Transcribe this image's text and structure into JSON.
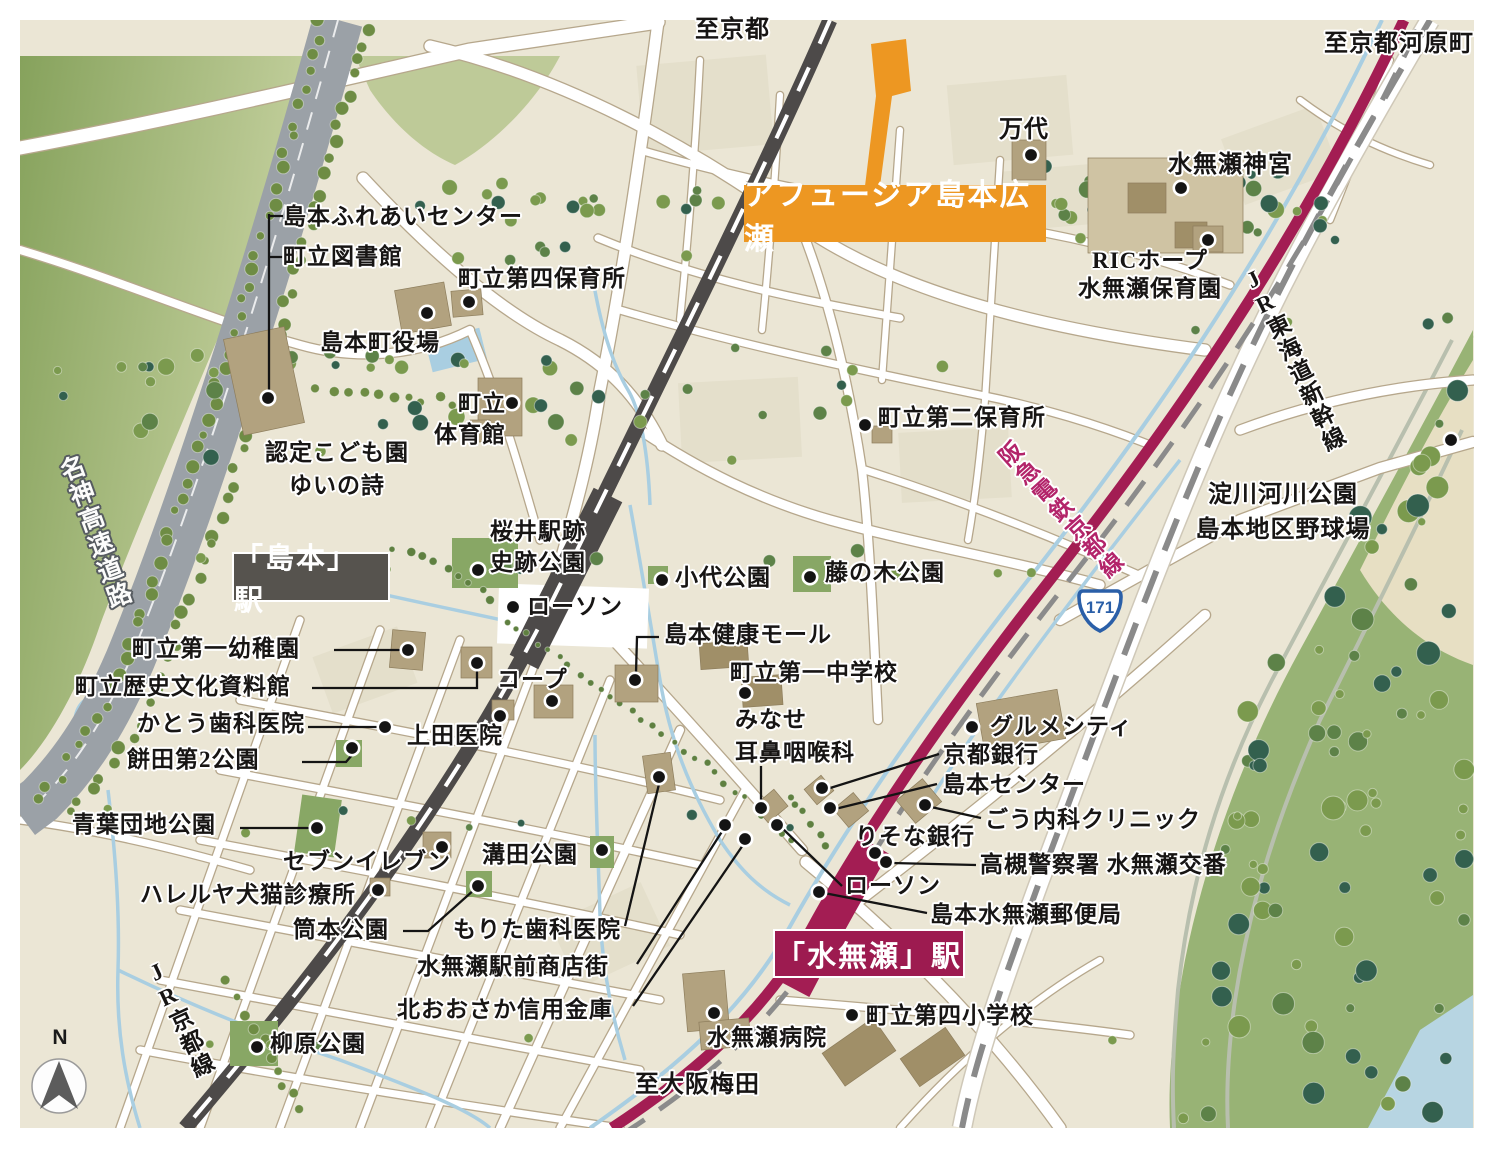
{
  "directions": {
    "to_kyoto": "至京都",
    "to_kyoto_kawaramachi": "至京都河原町",
    "to_osaka_umeda": "至大阪梅田"
  },
  "project": {
    "name": "アフュージア島本広瀬"
  },
  "stations": {
    "shimamoto": "「島本」駅",
    "minase": "「水無瀬」駅"
  },
  "railways": {
    "jr_kyoto_line": "JR京都線",
    "jr_tokaido_shinkansen": "JR東海道新幹線",
    "hankyu_kyoto_line": "阪急電鉄京都線",
    "meishin_expressway": "名神高速道路",
    "route_171": "171"
  },
  "compass": {
    "north": "N"
  },
  "pois": {
    "mandai": "万代",
    "minase_jingu": "水無瀬神宮",
    "ric_hope_line1": "RICホープ",
    "ric_hope_line2": "水無瀬保育園",
    "shimamoto_fureai_center": "島本ふれあいセンター",
    "town_library": "町立図書館",
    "dai4_hoikusho": "町立第四保育所",
    "shimamoto_yakuba": "島本町役場",
    "taiikukan_line1": "町立",
    "taiikukan_line2": "体育館",
    "kodomoen_line1": "認定こども園",
    "kodomoen_line2": "ゆいの詩",
    "dai2_hoikusho": "町立第二保育所",
    "yodogawa_line1": "淀川河川公園",
    "yodogawa_line2": "島本地区野球場",
    "sakurai_line1": "桜井駅跡",
    "sakurai_line2": "史跡公園",
    "lawson_north": "ローソン",
    "koshiro_koen": "小代公園",
    "fujinoki_koen": "藤の木公園",
    "kenko_mall": "島本健康モール",
    "dai1_chugakko": "町立第一中学校",
    "jibika_line1": "みなせ",
    "jibika_line2": "耳鼻咽喉科",
    "dai1_yochien": "町立第一幼稚園",
    "rekishi_shiryokan": "町立歴史文化資料館",
    "kato_shika": "かとう歯科医院",
    "mochida_koen": "餅田第2公園",
    "coop": "コープ",
    "ueda_iin": "上田医院",
    "gourmet_city": "グルメシティ",
    "kyoto_bank": "京都銀行",
    "shimamoto_center": "島本センター",
    "go_naika_clinic": "ごう内科クリニック",
    "resona_bank": "りそな銀行",
    "minase_koban": "高槻警察署 水無瀬交番",
    "lawson_south": "ローソン",
    "post_office": "島本水無瀬郵便局",
    "aoba_danchi_koen": "青葉団地公園",
    "seven_eleven": "セブンイレブン",
    "hallelujah_clinic": "ハレルヤ犬猫診療所",
    "tsutsumoto_koen": "筒本公園",
    "mizota_koen": "溝田公園",
    "morita_shika": "もりた歯科医院",
    "minase_shotengai": "水無瀬駅前商店街",
    "kita_osaka_shinkin": "北おおさか信用金庫",
    "minase_byoin": "水無瀬病院",
    "dai4_shogakko": "町立第四小学校",
    "yanagihara_koen": "柳原公園"
  },
  "colors": {
    "base": "#ebe6d5",
    "shade": "#e2dcc7",
    "road_casing": "#b6a78c",
    "expressway": "#9ba1a7",
    "jr": "#4d4a49",
    "hankyu": "#a31d53",
    "shinkansen_dash": "#8a8a8a",
    "water": "#a9cee1",
    "riverside_green": "#98b375",
    "park_green": "#88a765",
    "building": "#b2a27f",
    "building_dark": "#a08f68",
    "grounds": "#cabb99",
    "shrine_ground": "#cfc3a3",
    "accent_orange": "#ed9722",
    "station_box_gray": "#56534e",
    "station_box_crimson": "#9d1b50",
    "route_sign_blue": "#2a5fa8",
    "hankyu_text": "#b3246a"
  }
}
